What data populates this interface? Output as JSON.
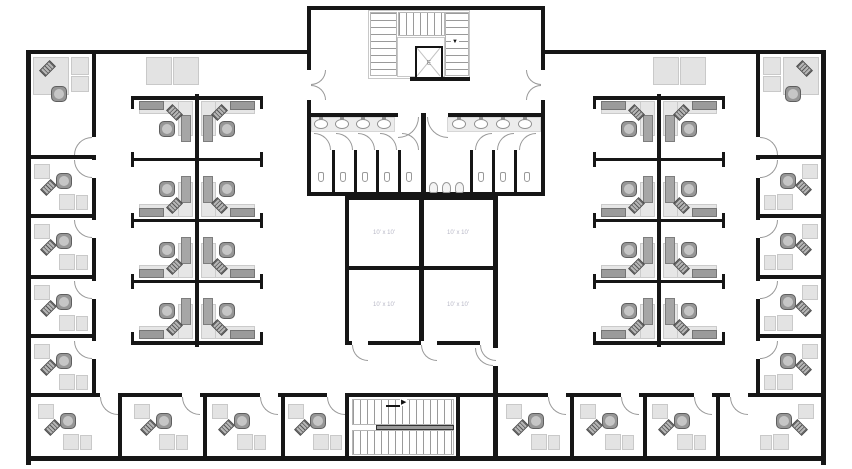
{
  "plan": {
    "elevator_label": "E",
    "rooms": [
      {
        "name": "room-top-left",
        "label": "10' x 10'"
      },
      {
        "name": "room-top-right",
        "label": "10' x 10'"
      },
      {
        "name": "room-bottom-left",
        "label": "10' x 10'"
      },
      {
        "name": "room-bottom-right",
        "label": "10' x 10'"
      }
    ],
    "stairs": {
      "top_direction_arrow": "▼",
      "bottom_direction_arrow": "▶"
    },
    "colors": {
      "wall": "#161616",
      "surface_light": "#e6e6e6",
      "surface_dark": "#9b9b9b",
      "chair": "#969696",
      "door_arc": "#999999",
      "room_label": "#b7b7c6"
    },
    "fixtures": {
      "sinks_per_restroom": 4,
      "stalls_left_restroom": 5,
      "stalls_right_restroom": 3,
      "urinals": 3,
      "cubicles_per_cluster": 8,
      "perimeter_offices": 18
    }
  }
}
